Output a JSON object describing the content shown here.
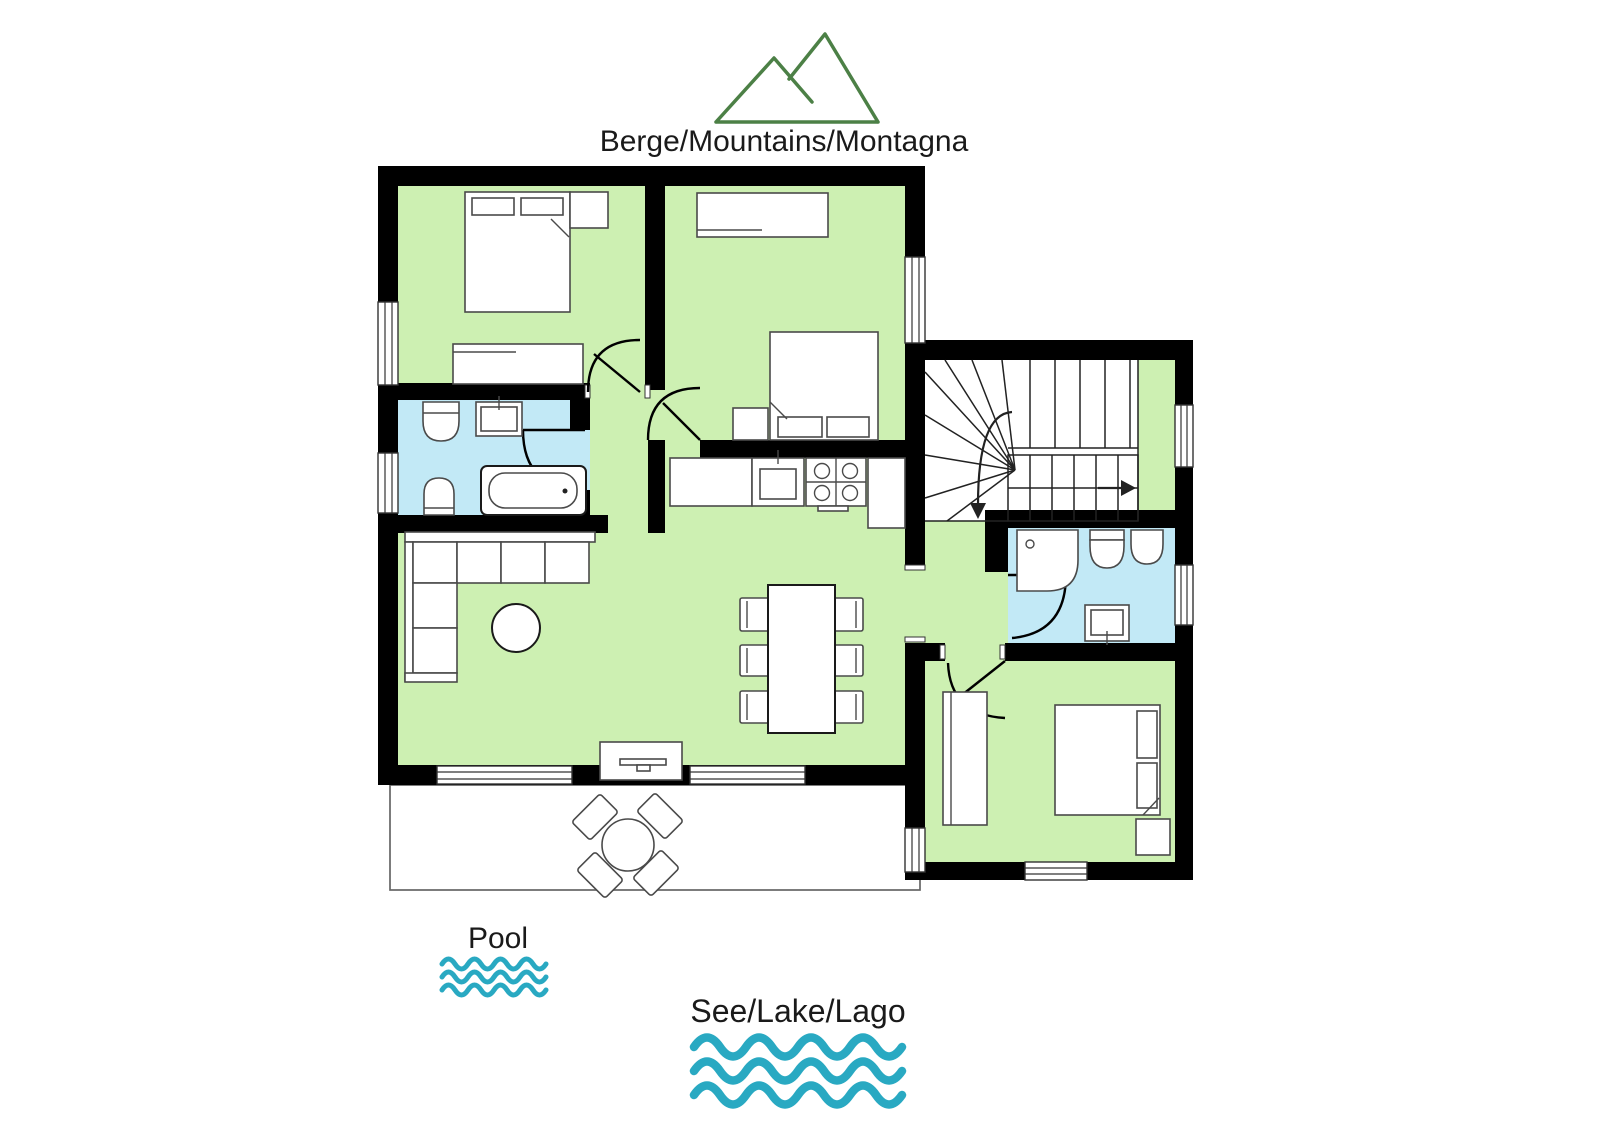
{
  "labels": {
    "mountains": "Berge/Mountains/Montagna",
    "pool": "Pool",
    "lake": "See/Lake/Lago"
  },
  "icons": {
    "mountains": "mountain-icon",
    "pool": "waves-icon",
    "lake": "waves-icon"
  },
  "colors": {
    "wall": "#000000",
    "room_fill": "#cdf0b2",
    "bathroom_fill": "#c2e9f6",
    "wave_teal": "#29a9c2",
    "mountain_green": "#4c8046",
    "text_color": "#1a1a1a"
  }
}
